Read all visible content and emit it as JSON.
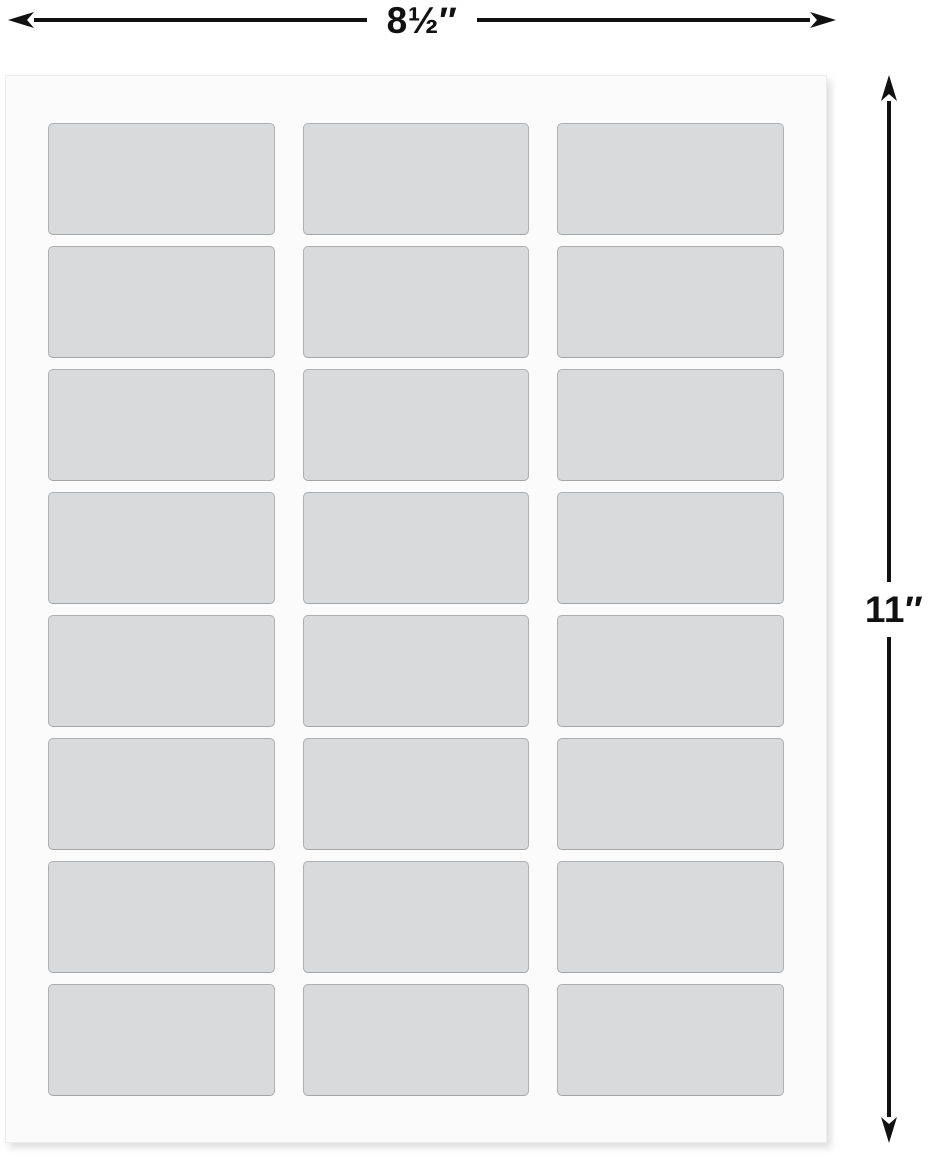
{
  "dimension_annotations": {
    "width_label": "8½″",
    "height_label": "11″"
  },
  "sheet": {
    "columns": 3,
    "rows": 8,
    "label_count": 24
  },
  "colors": {
    "annotation": "#111111",
    "sheet_fill": "#fbfbfc",
    "label_fill": "#d9dadb",
    "label_border": "#aeb0b2"
  }
}
